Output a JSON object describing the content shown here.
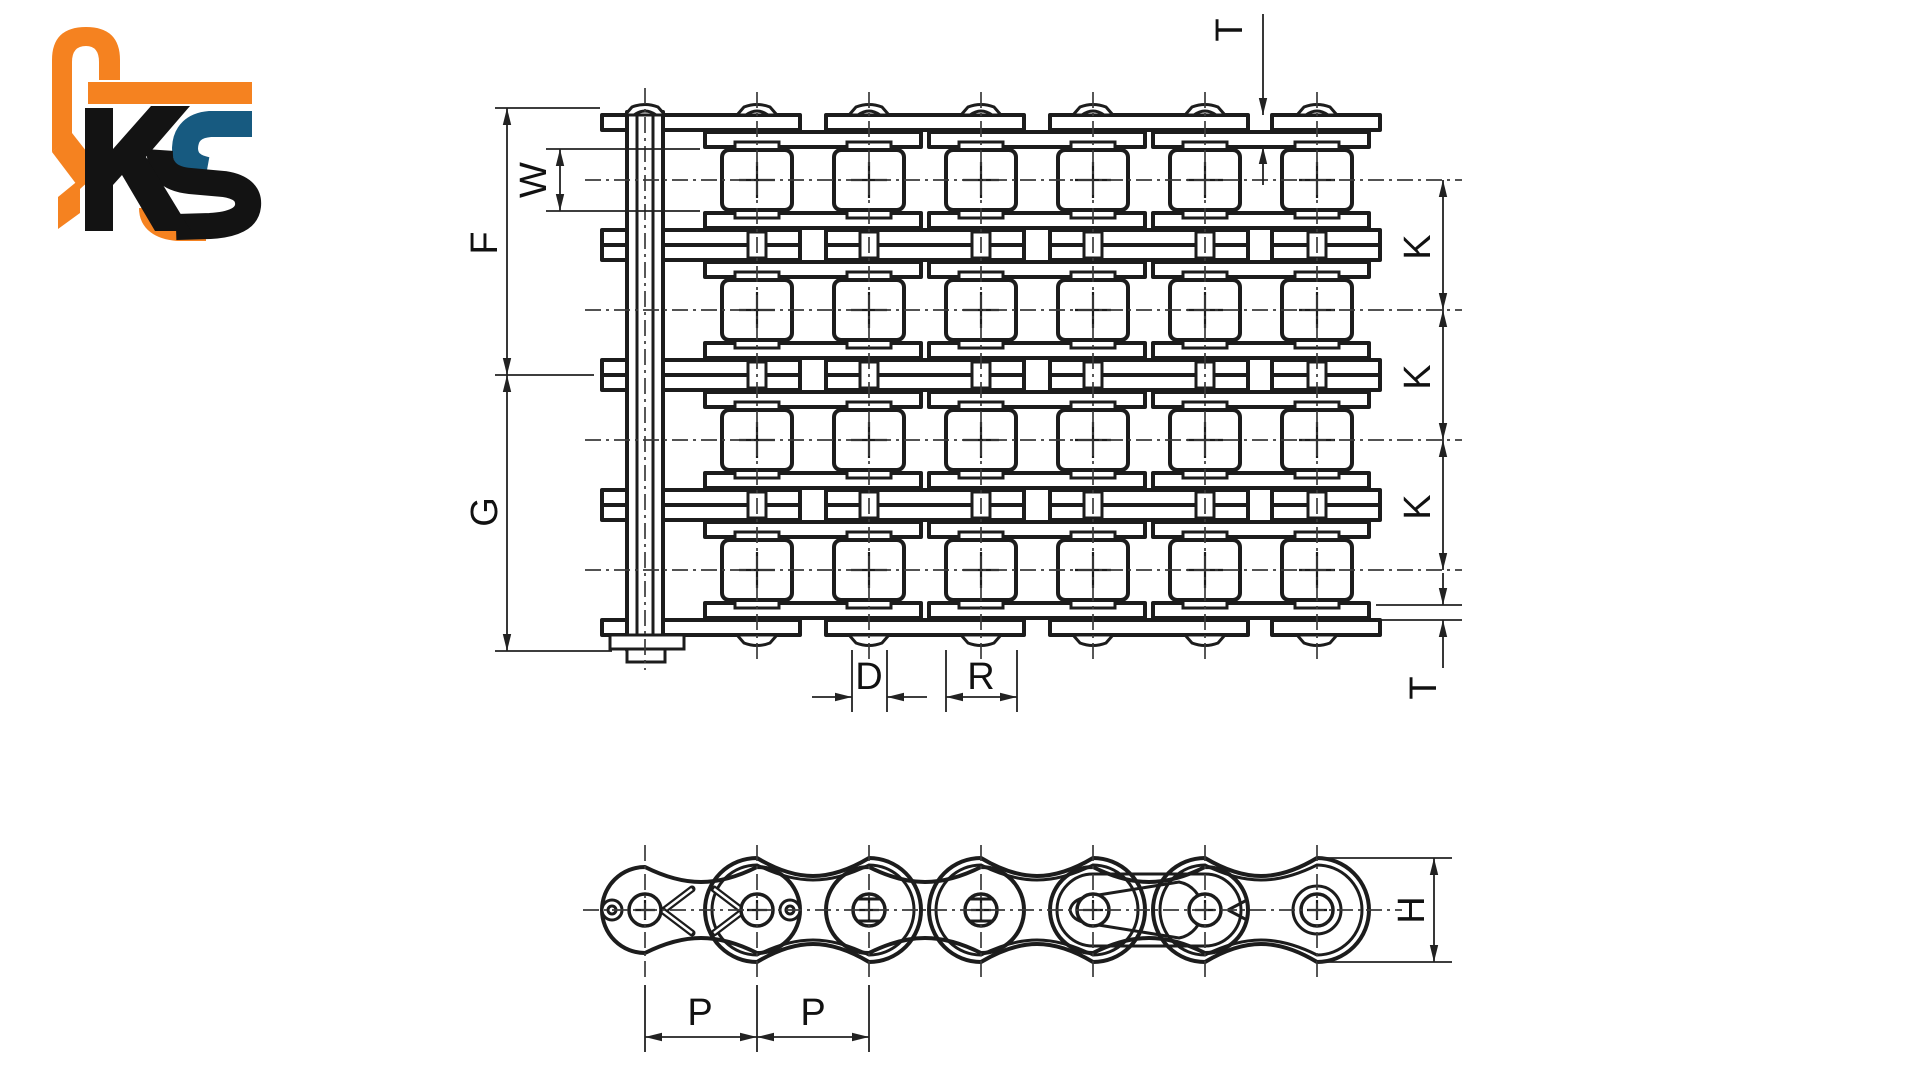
{
  "logo": {
    "text": "KS"
  },
  "colors": {
    "background": "#ffffff",
    "line": "#1c1c1c",
    "centerline": "#3a3a3a",
    "dimension": "#222222",
    "logo_orange": "#f58220",
    "logo_blue": "#175a80",
    "logo_black": "#131313"
  },
  "labels": {
    "F": "F",
    "G": "G",
    "W": "W",
    "K": "K",
    "T": "T",
    "D": "D",
    "R": "R",
    "P": "P",
    "H": "H"
  },
  "figure": {
    "top_view_strands": 4,
    "top_view_pin_columns": 7,
    "side_view_pins": 7
  }
}
